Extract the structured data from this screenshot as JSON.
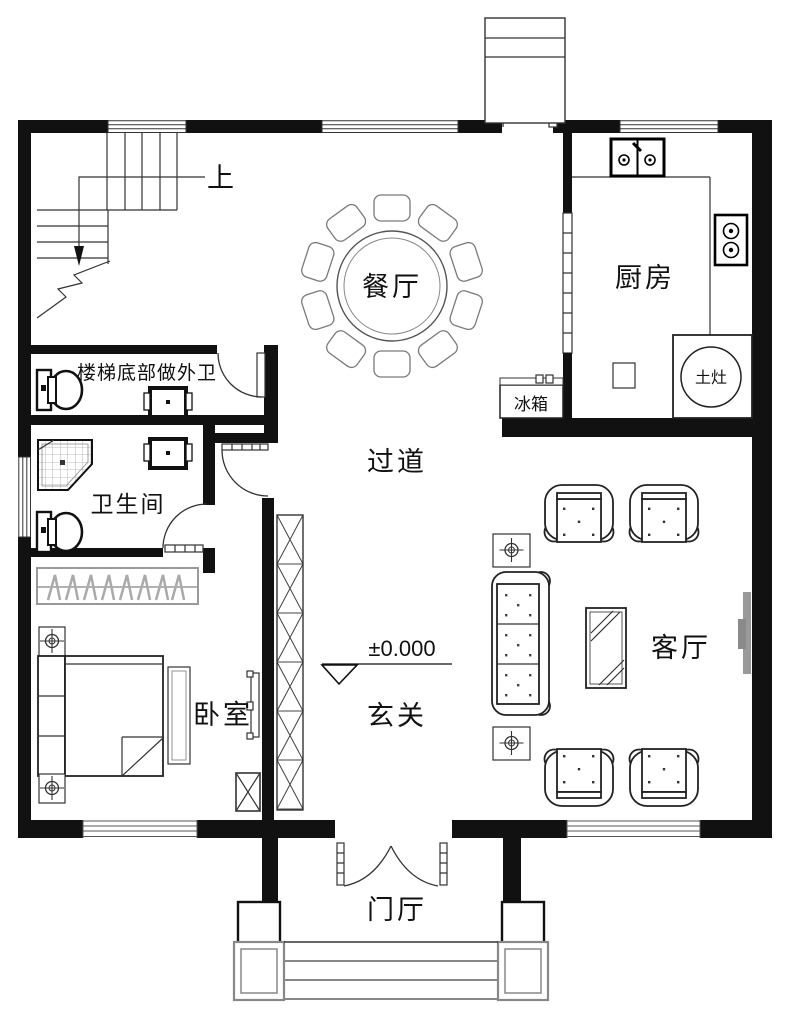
{
  "plan": {
    "rooms": {
      "dining": {
        "label": "餐厅"
      },
      "kitchen": {
        "label": "厨房"
      },
      "corridor": {
        "label": "过道"
      },
      "bathroom": {
        "label": "卫生间"
      },
      "bedroom": {
        "label": "卧室"
      },
      "foyer": {
        "label": "玄关"
      },
      "living": {
        "label": "客厅"
      },
      "porch": {
        "label": "门厅"
      }
    },
    "annotations": {
      "stairs_up": "上",
      "under_stairs_note": "楼梯底部做外卫",
      "level_mark": "±0.000",
      "fridge": "冰箱",
      "earthen_stove": "土灶"
    },
    "colors": {
      "wall": "#111111",
      "line": "#333333",
      "light_line": "#999999",
      "background": "#ffffff"
    }
  }
}
